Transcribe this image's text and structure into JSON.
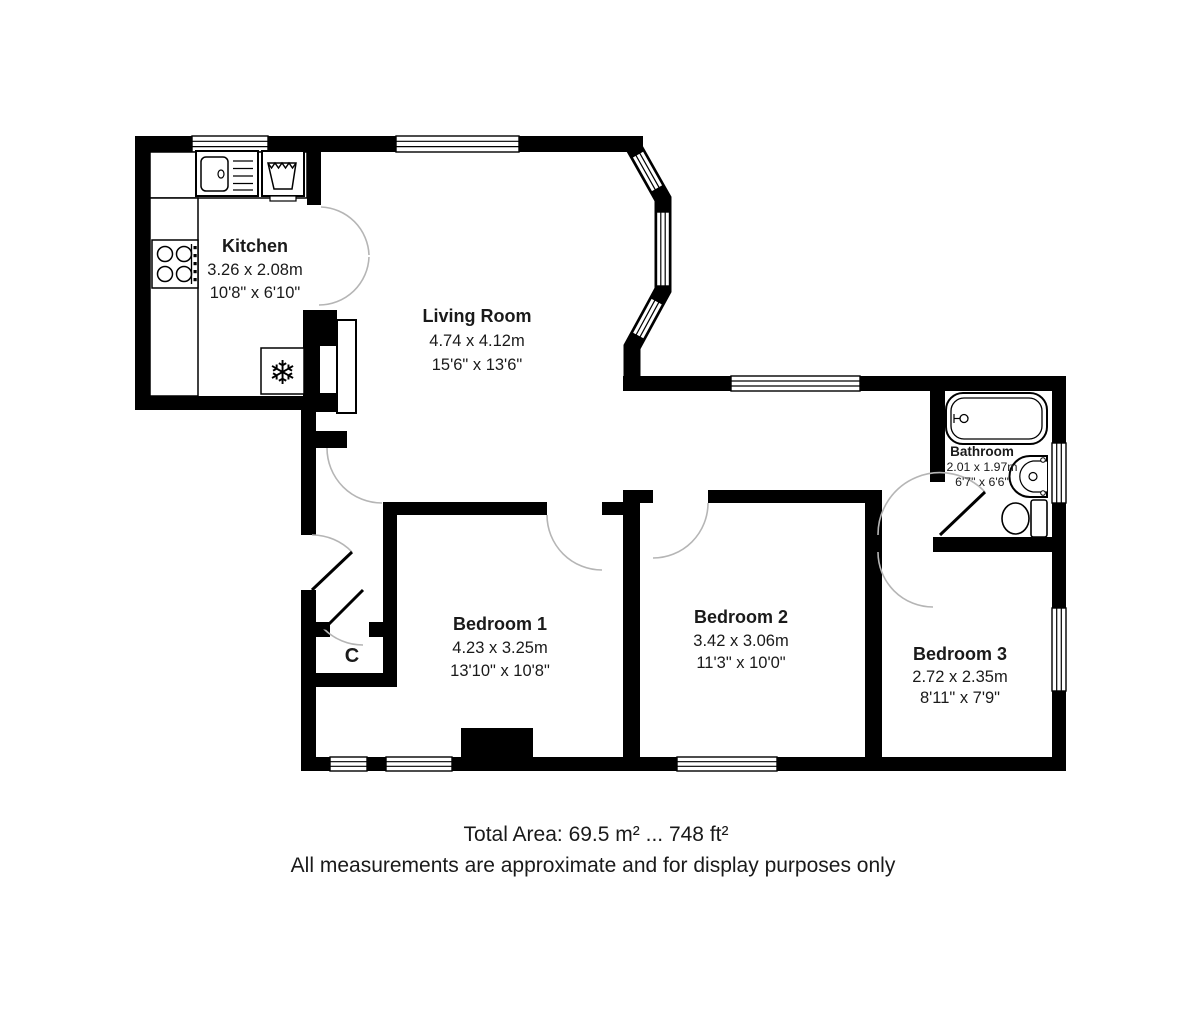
{
  "floorplan": {
    "rooms": {
      "kitchen": {
        "name": "Kitchen",
        "metric": "3.26 x 2.08m",
        "imperial": "10'8\" x 6'10\""
      },
      "living_room": {
        "name": "Living Room",
        "metric": "4.74 x 4.12m",
        "imperial": "15'6\" x 13'6\""
      },
      "bathroom": {
        "name": "Bathroom",
        "metric": "2.01 x 1.97m",
        "imperial": "6'7\" x 6'6\""
      },
      "bedroom_1": {
        "name": "Bedroom 1",
        "metric": "4.23 x 3.25m",
        "imperial": "13'10\" x 10'8\""
      },
      "bedroom_2": {
        "name": "Bedroom 2",
        "metric": "3.42 x 3.06m",
        "imperial": "11'3\" x 10'0\""
      },
      "bedroom_3": {
        "name": "Bedroom 3",
        "metric": "2.72 x 2.35m",
        "imperial": "8'11\" x 7'9\""
      },
      "closet": {
        "name": "C"
      }
    },
    "fixtures": {
      "fridge_glyph": "❄"
    },
    "footer": {
      "total_area": "Total Area: 69.5 m² ... 748 ft²",
      "disclaimer": "All measurements are approximate and for display purposes only"
    },
    "colors": {
      "wall": "#000000",
      "text": "#1a1a1a",
      "door_arc": "#b5b5b5"
    }
  }
}
